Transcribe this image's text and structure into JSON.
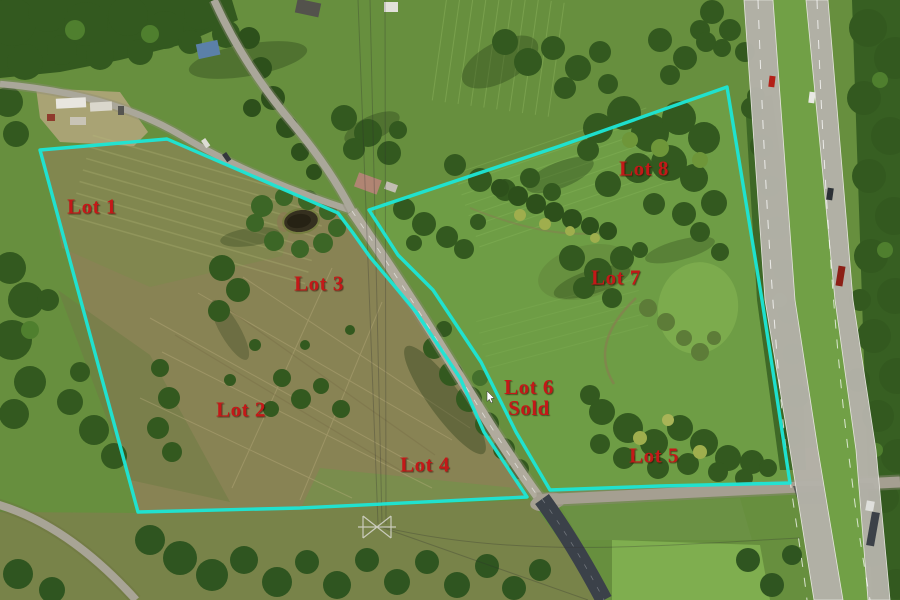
{
  "map": {
    "boundary_color": "#1de5d4",
    "label_color": "#c41818",
    "parcels": {
      "west": {
        "points": "40,150 167,139 338,213 353,233 370,257 392,283 416,312 460,378 484,432 527,497 300,508 138,512"
      },
      "east": {
        "points": "369,210 560,146 727,87 762,300 790,483 660,486 550,490 516,432 481,362 433,290 398,255"
      }
    },
    "lots": [
      {
        "label": "Lot 1",
        "x": 92,
        "y": 207
      },
      {
        "label": "Lot 2",
        "x": 241,
        "y": 410
      },
      {
        "label": "Lot 3",
        "x": 319,
        "y": 284
      },
      {
        "label": "Lot 4",
        "x": 425,
        "y": 465
      },
      {
        "label": "Lot 5",
        "x": 654,
        "y": 456
      },
      {
        "label": "Lot 6",
        "x": 529,
        "y": 398,
        "status": "Sold"
      },
      {
        "label": "Lot 7",
        "x": 616,
        "y": 278
      },
      {
        "label": "Lot 8",
        "x": 644,
        "y": 169
      }
    ]
  }
}
